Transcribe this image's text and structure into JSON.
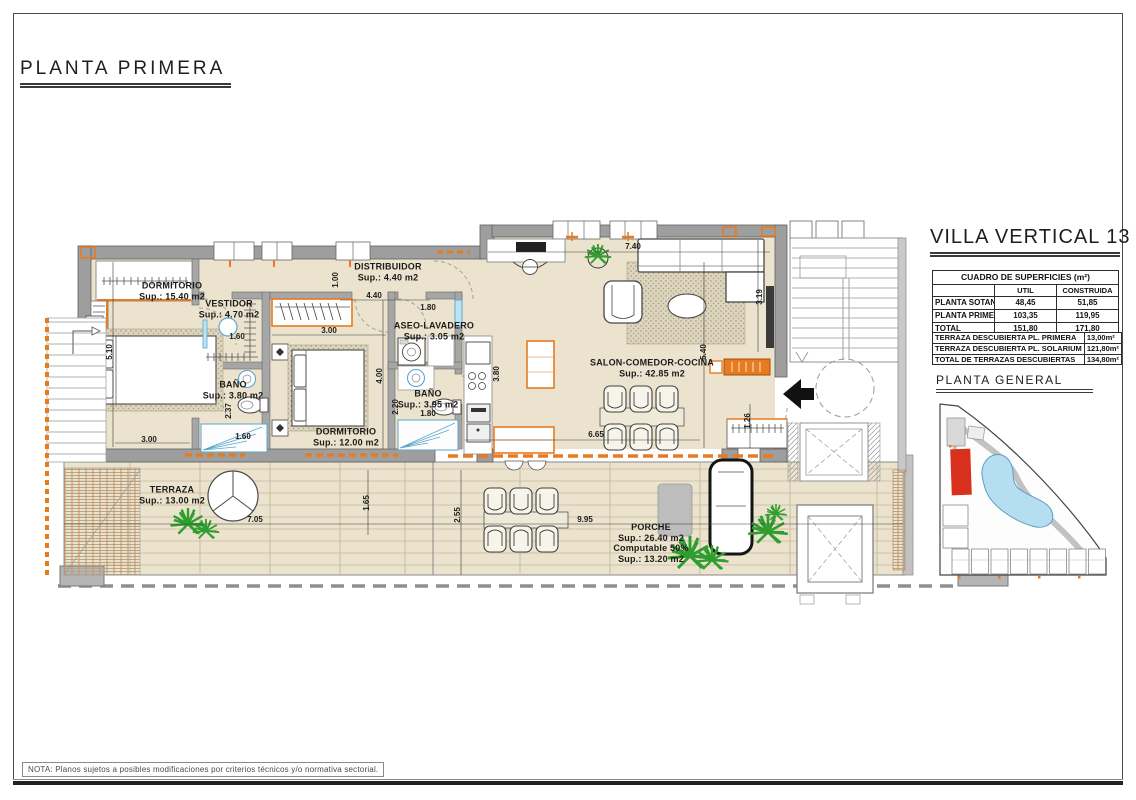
{
  "page": {
    "title": "PLANTA PRIMERA",
    "note": "NOTA: Planos sujetos a posibles modificaciones por criterios técnicos y/o normativa sectorial."
  },
  "sidebar": {
    "project_title": "VILLA VERTICAL 13",
    "surfaces_table": {
      "title": "CUADRO DE SUPERFICIES (m²)",
      "col_util": "UTIL",
      "col_construida": "CONSTRUIDA",
      "rows": [
        {
          "label": "PLANTA SOTANO",
          "util": "48,45",
          "construida": "51,85"
        },
        {
          "label": "PLANTA PRIMERA",
          "util": "103,35",
          "construida": "119,95"
        },
        {
          "label": "TOTAL",
          "util": "151,80",
          "construida": "171,80"
        }
      ]
    },
    "terraces_table": {
      "rows": [
        {
          "label": "TERRAZA DESCUBIERTA PL. PRIMERA",
          "value": "13,00m²"
        },
        {
          "label": "TERRAZA DESCUBIERTA PL. SOLARIUM",
          "value": "121,80m²"
        },
        {
          "label": "TOTAL DE TERRAZAS DESCUBIERTAS",
          "value": "134,80m²"
        }
      ]
    },
    "site_plan_title": "PLANTA  GENERAL"
  },
  "plan": {
    "rooms": [
      {
        "lines": [
          "DORMITORIO",
          "Sup.: 15.40  m2"
        ],
        "x": 172,
        "y": 291
      },
      {
        "lines": [
          "VESTIDOR",
          "Sup.: 4.70  m2"
        ],
        "x": 229,
        "y": 309
      },
      {
        "lines": [
          "DISTRIBUIDOR",
          "Sup.: 4.40  m2"
        ],
        "x": 388,
        "y": 272
      },
      {
        "lines": [
          "ASEO-LAVADERO",
          "Sup.: 3.05  m2"
        ],
        "x": 434,
        "y": 331
      },
      {
        "lines": [
          "BAÑO",
          "Sup.: 3.80  m2"
        ],
        "x": 233,
        "y": 390
      },
      {
        "lines": [
          "DORMITORIO",
          "Sup.: 12.00  m2"
        ],
        "x": 346,
        "y": 437
      },
      {
        "lines": [
          "BAÑO",
          "Sup.: 3.95  m2"
        ],
        "x": 428,
        "y": 399
      },
      {
        "lines": [
          "SALON-COMEDOR-COCINA",
          "Sup.: 42.85  m2"
        ],
        "x": 652,
        "y": 368
      },
      {
        "lines": [
          "TERRAZA",
          "Sup.: 13.00  m2"
        ],
        "x": 172,
        "y": 495
      },
      {
        "lines": [
          "PORCHE",
          "Sup.: 26.40  m2",
          "Computable 50%",
          "Sup.: 13.20  m2"
        ],
        "x": 651,
        "y": 543
      }
    ],
    "dims": [
      {
        "t": "7.40",
        "x": 633,
        "y": 247,
        "v": 0
      },
      {
        "t": "4.40",
        "x": 374,
        "y": 296,
        "v": 0
      },
      {
        "t": "1.00",
        "x": 336,
        "y": 280,
        "v": 1
      },
      {
        "t": "1.80",
        "x": 428,
        "y": 308,
        "v": 0
      },
      {
        "t": "3.00",
        "x": 329,
        "y": 331,
        "v": 0
      },
      {
        "t": "1.60",
        "x": 237,
        "y": 337,
        "v": 0
      },
      {
        "t": "5.10",
        "x": 110,
        "y": 352,
        "v": 1
      },
      {
        "t": "3.00",
        "x": 149,
        "y": 440,
        "v": 0
      },
      {
        "t": "2.37",
        "x": 229,
        "y": 411,
        "v": 1
      },
      {
        "t": "1.60",
        "x": 243,
        "y": 437,
        "v": 0
      },
      {
        "t": "4.00",
        "x": 380,
        "y": 376,
        "v": 1
      },
      {
        "t": "2.20",
        "x": 396,
        "y": 407,
        "v": 1
      },
      {
        "t": "1.80",
        "x": 428,
        "y": 414,
        "v": 0
      },
      {
        "t": "3.80",
        "x": 497,
        "y": 374,
        "v": 1
      },
      {
        "t": "6.65",
        "x": 596,
        "y": 435,
        "v": 0
      },
      {
        "t": "5.40",
        "x": 704,
        "y": 352,
        "v": 1
      },
      {
        "t": "3.19",
        "x": 760,
        "y": 297,
        "v": 1
      },
      {
        "t": "1.26",
        "x": 748,
        "y": 421,
        "v": 1
      },
      {
        "t": "7.05",
        "x": 255,
        "y": 520,
        "v": 0
      },
      {
        "t": "1.65",
        "x": 367,
        "y": 503,
        "v": 1
      },
      {
        "t": "2.55",
        "x": 458,
        "y": 515,
        "v": 1
      },
      {
        "t": "9.95",
        "x": 585,
        "y": 520,
        "v": 0
      }
    ]
  },
  "colors": {
    "accent_orange": "#e87a20",
    "wall_gray": "#9e9e9e",
    "floor_beige": "#ebe3cd",
    "fixture_blue": "#58a8cc",
    "plant_green": "#2f9e2f",
    "highlight_red": "#d8301c",
    "pool_blue": "#b5dff0"
  }
}
